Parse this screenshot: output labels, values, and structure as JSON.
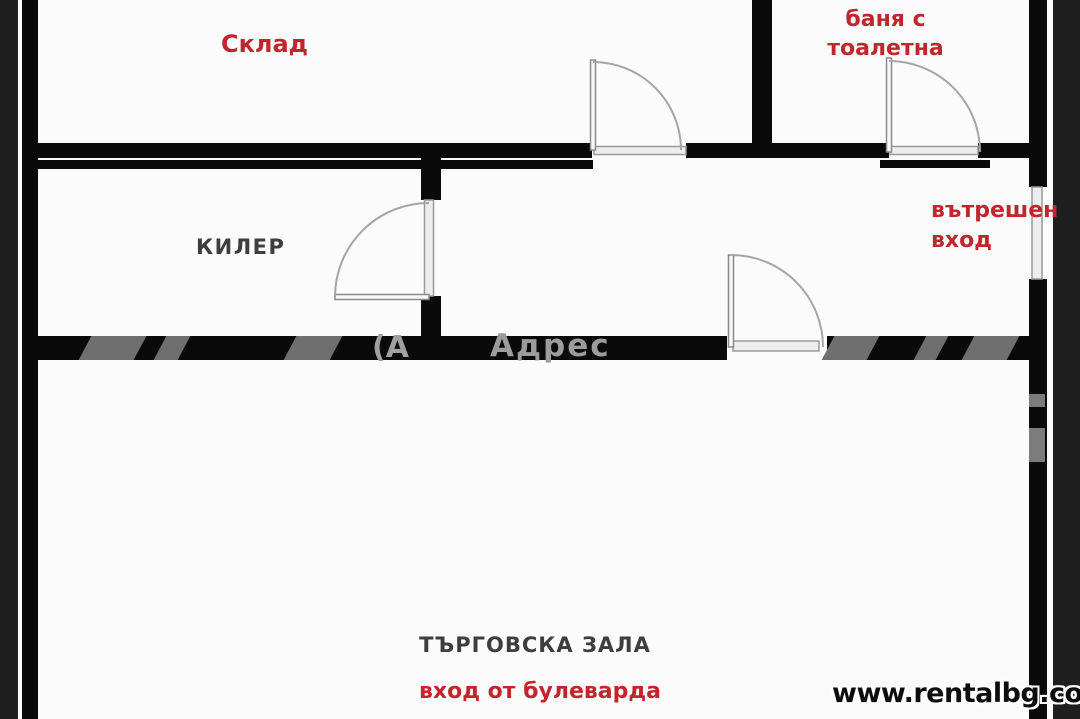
{
  "floorplan": {
    "rooms": {
      "storage": {
        "label": "Склад"
      },
      "bathroom": {
        "line1": "баня с",
        "line2": "тоалетна"
      },
      "pantry": {
        "label": "КИЛЕР"
      },
      "inner_entrance": {
        "line1": "вътрешен",
        "line2": "вход"
      },
      "trade_hall": {
        "label": "ТЪРГОВСКА ЗАЛА"
      },
      "boulevard_entrance": {
        "label": "вход от булеварда"
      }
    },
    "watermark": {
      "brand_fragment": "(А",
      "brand": "Адрес",
      "site": "www.rentalbg.com"
    }
  },
  "colors": {
    "label-red": "#c2252c",
    "label-dark": "#3e3e3e",
    "wall": "#0a0a0a",
    "edge-band": "#1f1f1f",
    "door-line": "#9b9b9b",
    "watermark-gray": "#9c9c9c",
    "watermark-stripe": "#6f6f6f",
    "background": "#fbfbfb"
  }
}
